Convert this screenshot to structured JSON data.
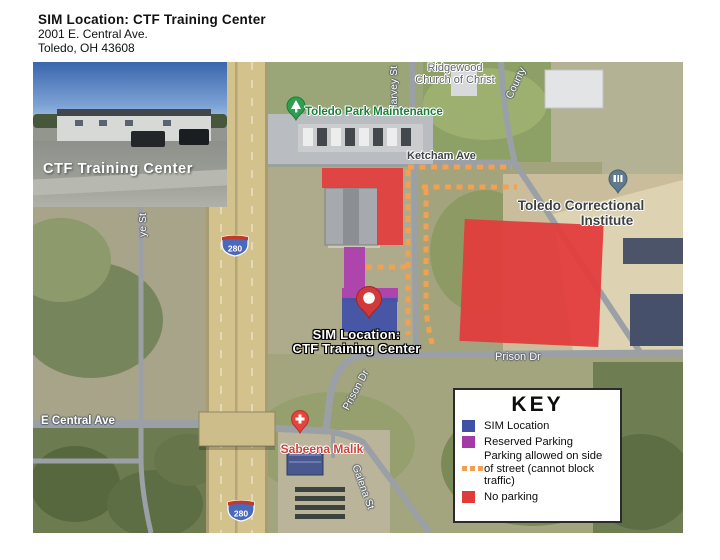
{
  "header": {
    "title": "SIM Location: CTF Training Center",
    "address1": "2001 E. Central Ave.",
    "address2": "Toledo, OH  43608"
  },
  "inset": {
    "caption": "CTF Training Center"
  },
  "map": {
    "labels": {
      "ridgewood_line1": "Ridgewood",
      "ridgewood_line2": "Church of Christ",
      "harvey_st": "Harvey St",
      "county_rd": "County",
      "park_maintenance": "Toledo Park Maintenance",
      "ketcham_ave": "Ketcham Ave",
      "correctional_line1": "Toledo Correctional",
      "correctional_line2": "Institute",
      "prison_dr_horizontal": "Prison Dr",
      "prison_dr_diagonal": "Prison Dr",
      "e_central_ave": "E Central Ave",
      "galena_st": "Galena St",
      "sabeena_malik": "Sabeena Malik",
      "ye_st": "ye St",
      "interstate_shield": "280"
    },
    "sim_callout": {
      "line1": "SIM Location:",
      "line2": "CTF Training Center"
    }
  },
  "key": {
    "title": "KEY",
    "items": [
      {
        "label": "SIM Location",
        "color": "#3f51a5"
      },
      {
        "label": "Reserved Parking",
        "color": "#a23ba8"
      },
      {
        "label": "Parking allowed on side of street (cannot block traffic)",
        "color": "#f0a052"
      },
      {
        "label": "No parking",
        "color": "#e03a3a"
      }
    ]
  },
  "colors": {
    "sim_blue": "#4152a8",
    "reserved_purple": "#ad3fae",
    "no_parking_red": "#e23d3d",
    "street_parking_orange": "#f2a052",
    "pin_red": "#d23a3a",
    "park_green": "#1a8038",
    "poi_rose": "#cc4439"
  }
}
